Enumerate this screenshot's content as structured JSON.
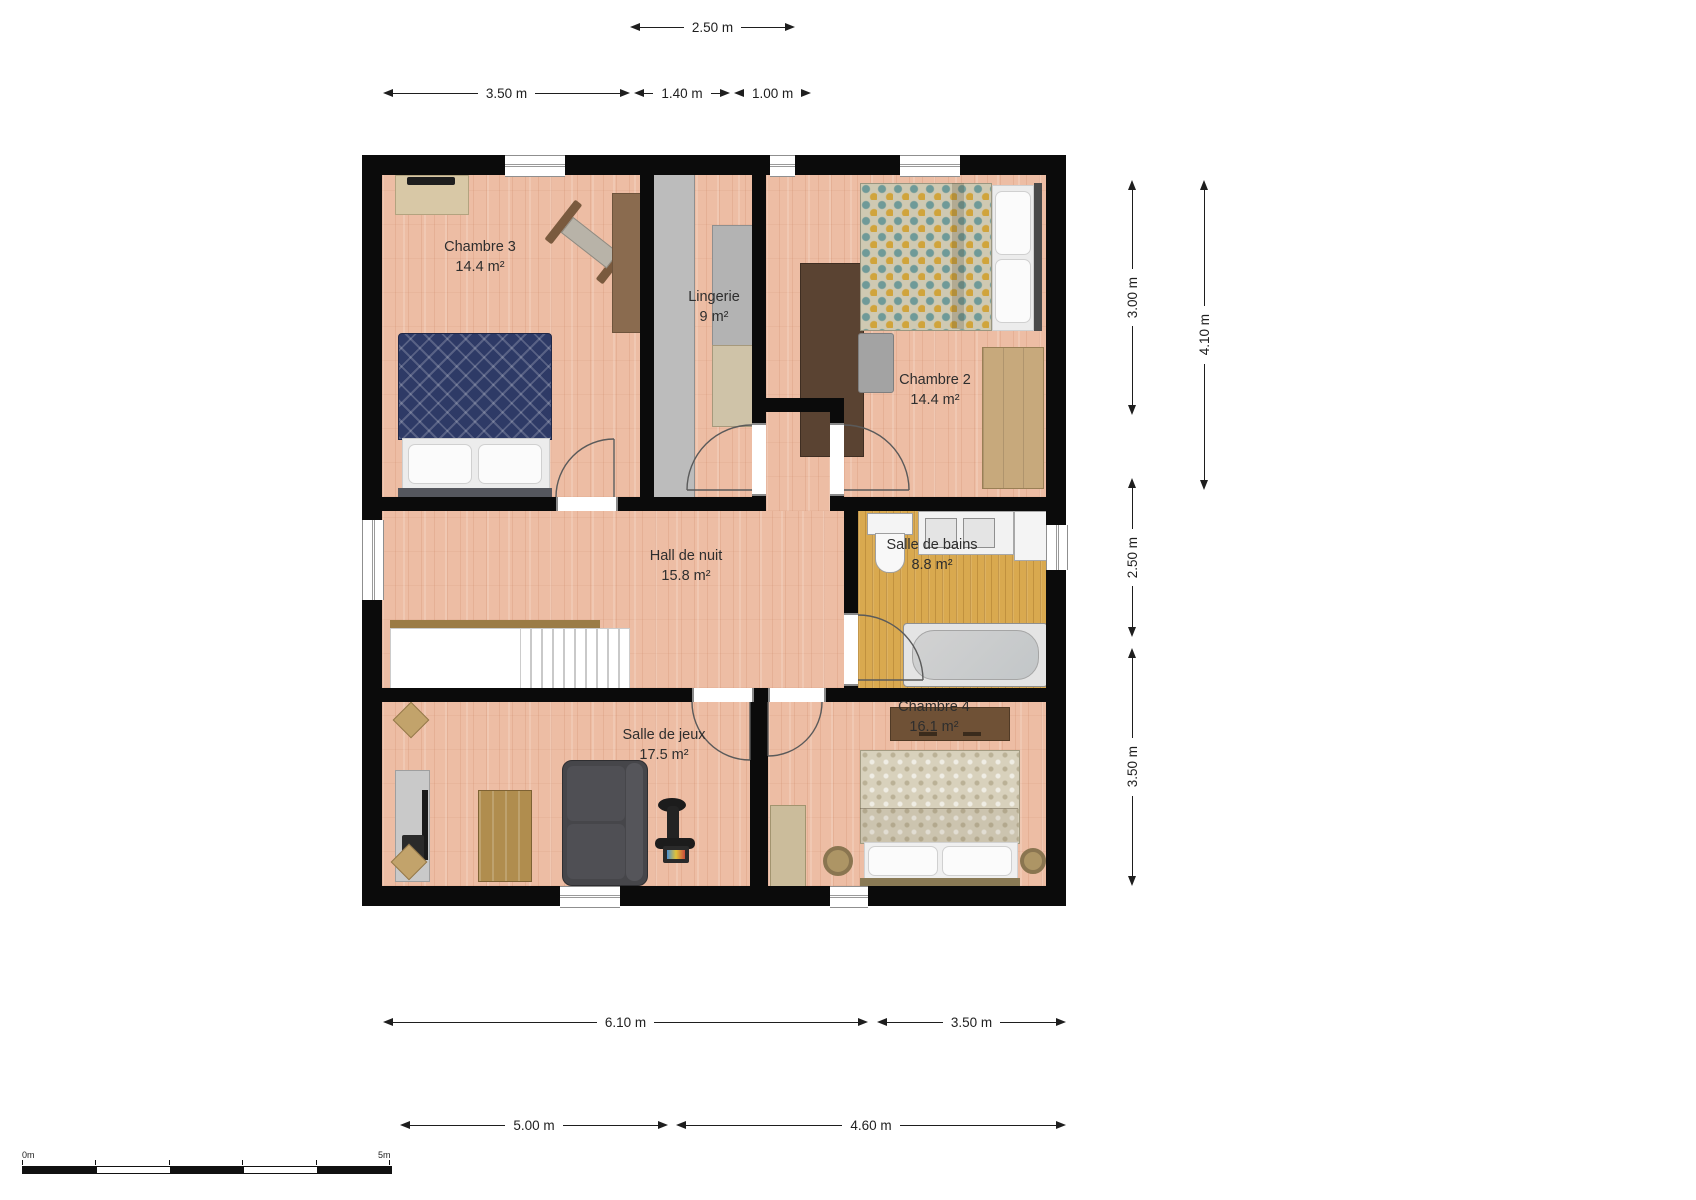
{
  "rooms": {
    "chambre3": {
      "name": "Chambre 3",
      "area": "14.4 m²"
    },
    "lingerie": {
      "name": "Lingerie",
      "area": "9 m²"
    },
    "chambre2": {
      "name": "Chambre 2",
      "area": "14.4 m²"
    },
    "hall": {
      "name": "Hall de nuit",
      "area": "15.8 m²"
    },
    "bains": {
      "name": "Salle de bains",
      "area": "8.8 m²"
    },
    "jeux": {
      "name": "Salle de jeux",
      "area": "17.5 m²"
    },
    "chambre4": {
      "name": "Chambre 4",
      "area": "16.1 m²"
    }
  },
  "dims": {
    "top_250": "2.50 m",
    "top_350": "3.50 m",
    "top_140": "1.40 m",
    "top_100": "1.00 m",
    "right_300": "3.00 m",
    "right_410": "4.10 m",
    "right_250": "2.50 m",
    "right_350": "3.50 m",
    "bottom_610": "6.10 m",
    "bottom_350": "3.50 m",
    "bottom_500": "5.00 m",
    "bottom_460": "4.60 m"
  },
  "scalebar": {
    "start": "0m",
    "end": "5m"
  },
  "colors": {
    "wall": "#0b0b0b",
    "floor_wood": "#edbda4",
    "floor_bath": "#d9a94f",
    "duvet_navy": "#2e3a66",
    "accent_teal": "#6f9a98",
    "accent_mustard": "#d0a43c"
  }
}
